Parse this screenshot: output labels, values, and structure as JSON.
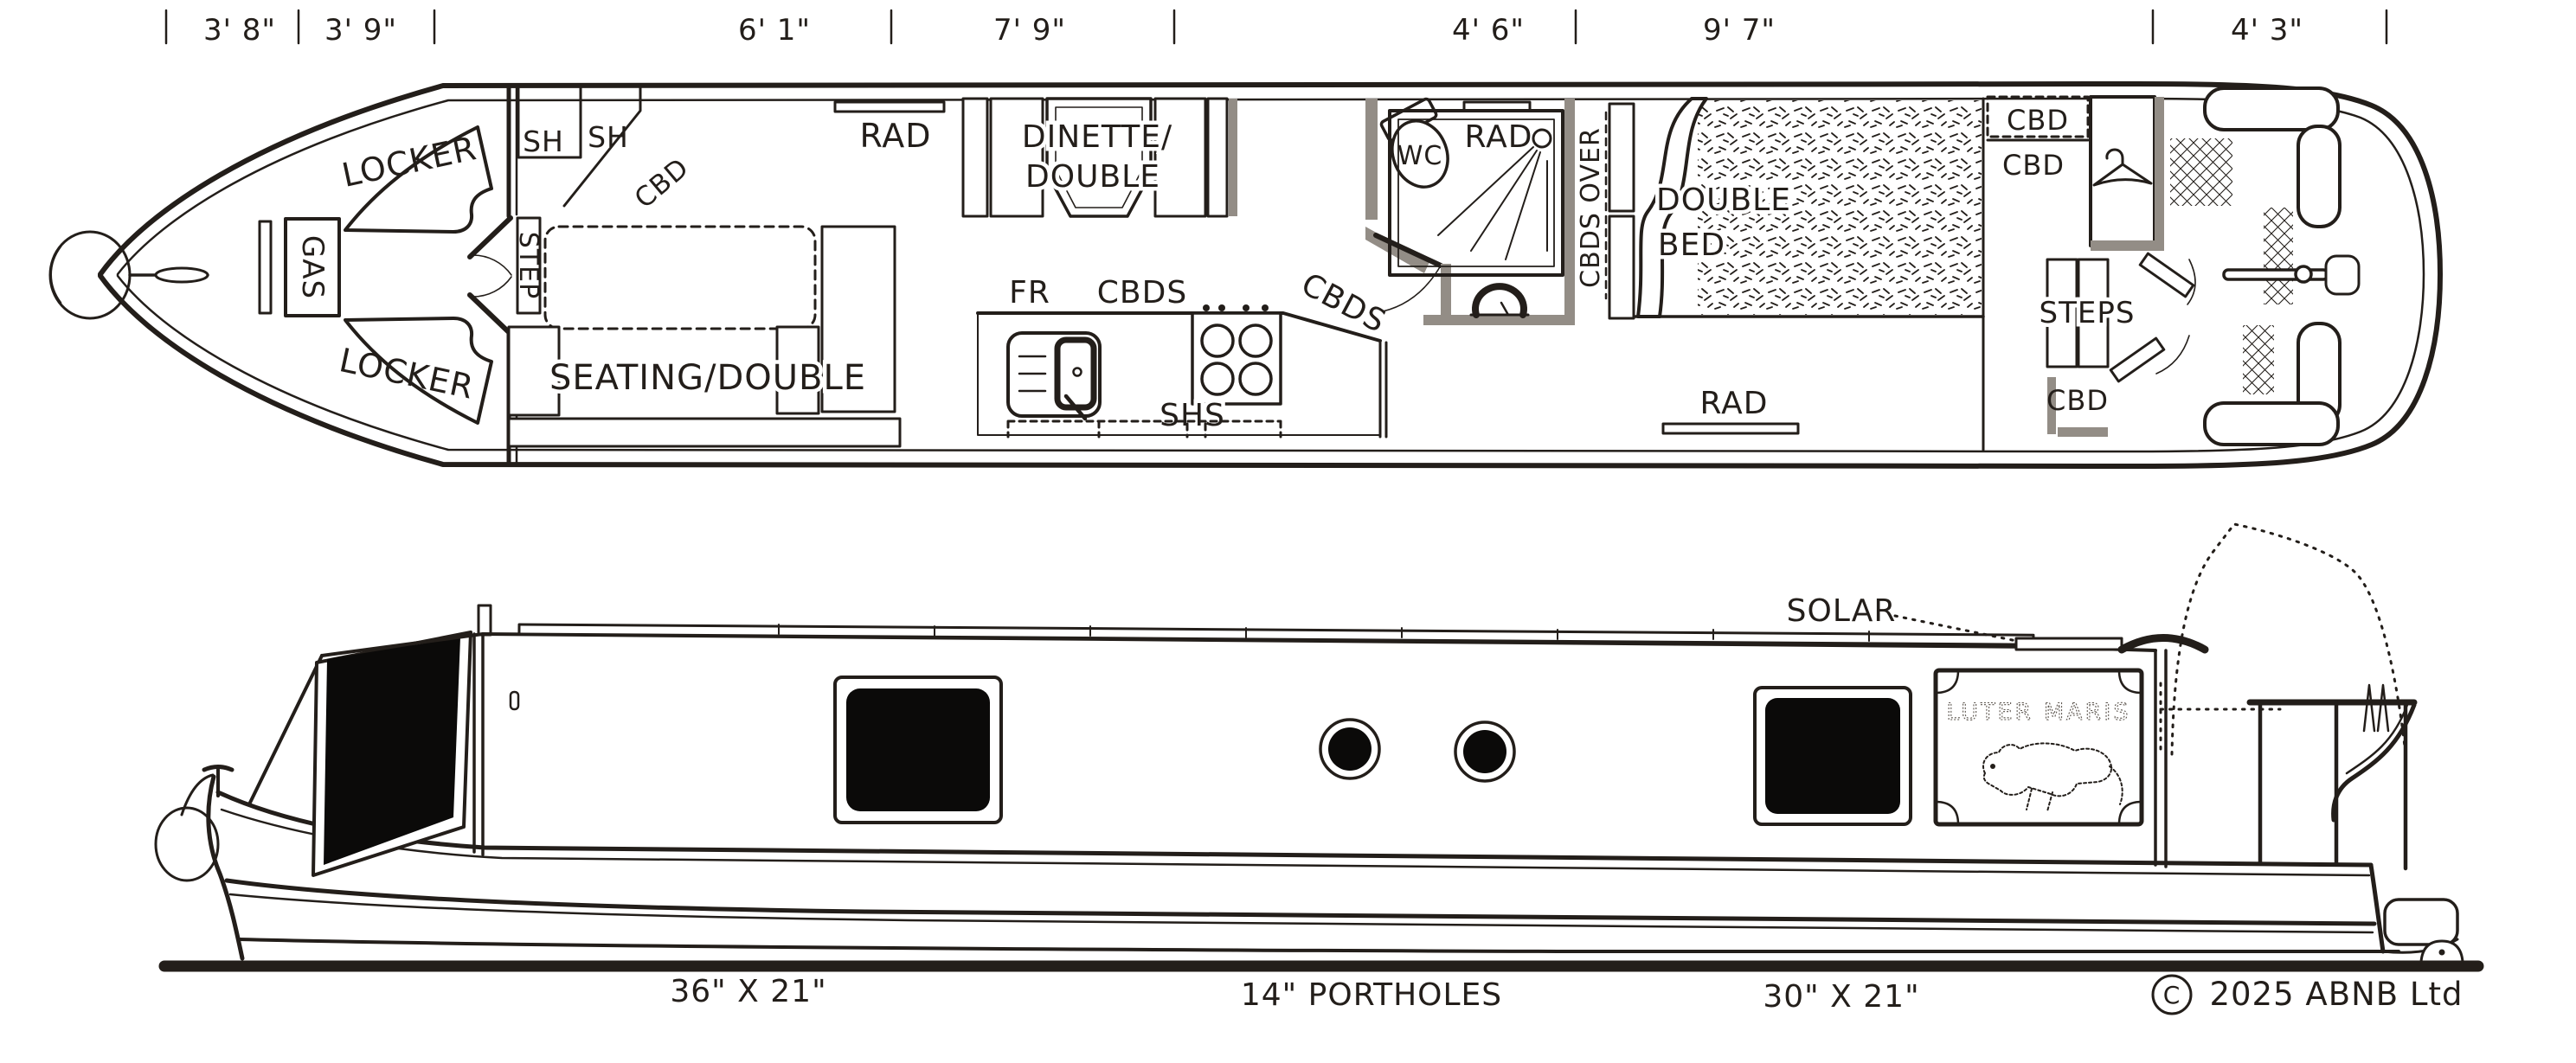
{
  "document": {
    "type": "narrowboat layout drawing",
    "ink_color": "#231e1a",
    "background": "#ffffff"
  },
  "dimension_row": {
    "labels": [
      "3' 8\"",
      "3' 9\"",
      "6' 1\"",
      "7' 9\"",
      "4' 6\"",
      "9' 7\"",
      "4' 3\""
    ]
  },
  "plan": {
    "bow": {
      "gas_locker": "GAS",
      "locker_top": "LOCKER",
      "locker_bottom": "LOCKER"
    },
    "entry": {
      "shelf_1": "SH",
      "shelf_2": "SH",
      "cupboard_angled": "CBD",
      "step": "STEP"
    },
    "saloon": {
      "seating": "SEATING/DOUBLE",
      "radiator": "RAD",
      "dinette_line1": "DINETTE/",
      "dinette_line2": "DOUBLE"
    },
    "galley": {
      "fridge": "FR",
      "cupboards": "CBDS",
      "cupboards_angled": "CBDS",
      "shelves": "SHS"
    },
    "bathroom": {
      "wc": "WC",
      "radiator": "RAD"
    },
    "bedroom": {
      "cupboards_over": "CBDS OVER",
      "bed_line1": "DOUBLE",
      "bed_line2": "BED",
      "radiator": "RAD"
    },
    "stern_cabin": {
      "cupboard_dashed": "CBD",
      "cupboard_mid": "CBD",
      "steps": "STEPS",
      "cupboard_low": "CBD"
    }
  },
  "side_view": {
    "solar_label": "SOLAR",
    "boat_name": "LUTER MARIS",
    "captions": {
      "fore_window": "36\" X 21\"",
      "portholes": "14\" PORTHOLES",
      "aft_window": "30\" X 21\""
    },
    "copyright": {
      "symbol": "C",
      "text": "2025 ABNB Ltd"
    }
  }
}
